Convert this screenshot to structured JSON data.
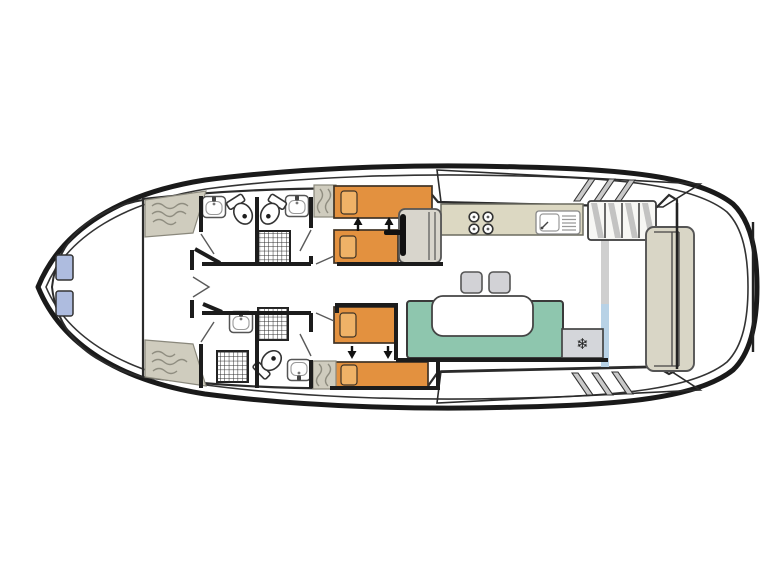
{
  "plan": {
    "type": "boat-deck-plan",
    "rooms": [
      "bow-cabin",
      "shower-room-port-forward",
      "shower-room-starboard-forward",
      "shower-room-port-aft",
      "shower-room-starboard-aft",
      "twin-cabin-starboard",
      "twin-cabin-port",
      "galley",
      "saloon",
      "side-deck-starboard",
      "side-deck-port",
      "aft-deck"
    ],
    "fixtures": [
      "double-bed-bow",
      "single-bed",
      "sliding-bed-arrows",
      "wardrobe",
      "washbasin",
      "toilet",
      "shower-tray",
      "helm-seat",
      "steering-wheel",
      "hob-4-burner",
      "sink-with-drainer",
      "fridge",
      "dinette-table",
      "u-shaped-seating",
      "stool",
      "stairs-to-flybridge",
      "deck-steps",
      "aft-bench",
      "swim-platform"
    ]
  },
  "icons": {
    "snowflake": "❄"
  },
  "colors": {
    "deck": "#ffffff",
    "hull_line": "#1a1a1a",
    "bow_bed": "#7e98c8",
    "bow_pillow": "#aebcdf",
    "interior": "#e7e3cf",
    "wardrobe": "#cfccbe",
    "bed": "#e3913f",
    "bed_pillow": "#efb267",
    "helm_seat": "#d8d5cc",
    "counter": "#dcd8c2",
    "seating": "#8ec6ae",
    "table": "#ffffff",
    "stool": "#d2d2d6",
    "fridge": "#d4d6da",
    "aft_bench": "#d9d6c6",
    "track": "#cfcfcf",
    "door_glass": "#b8d2e6",
    "stairs": "#f7f7f4"
  }
}
